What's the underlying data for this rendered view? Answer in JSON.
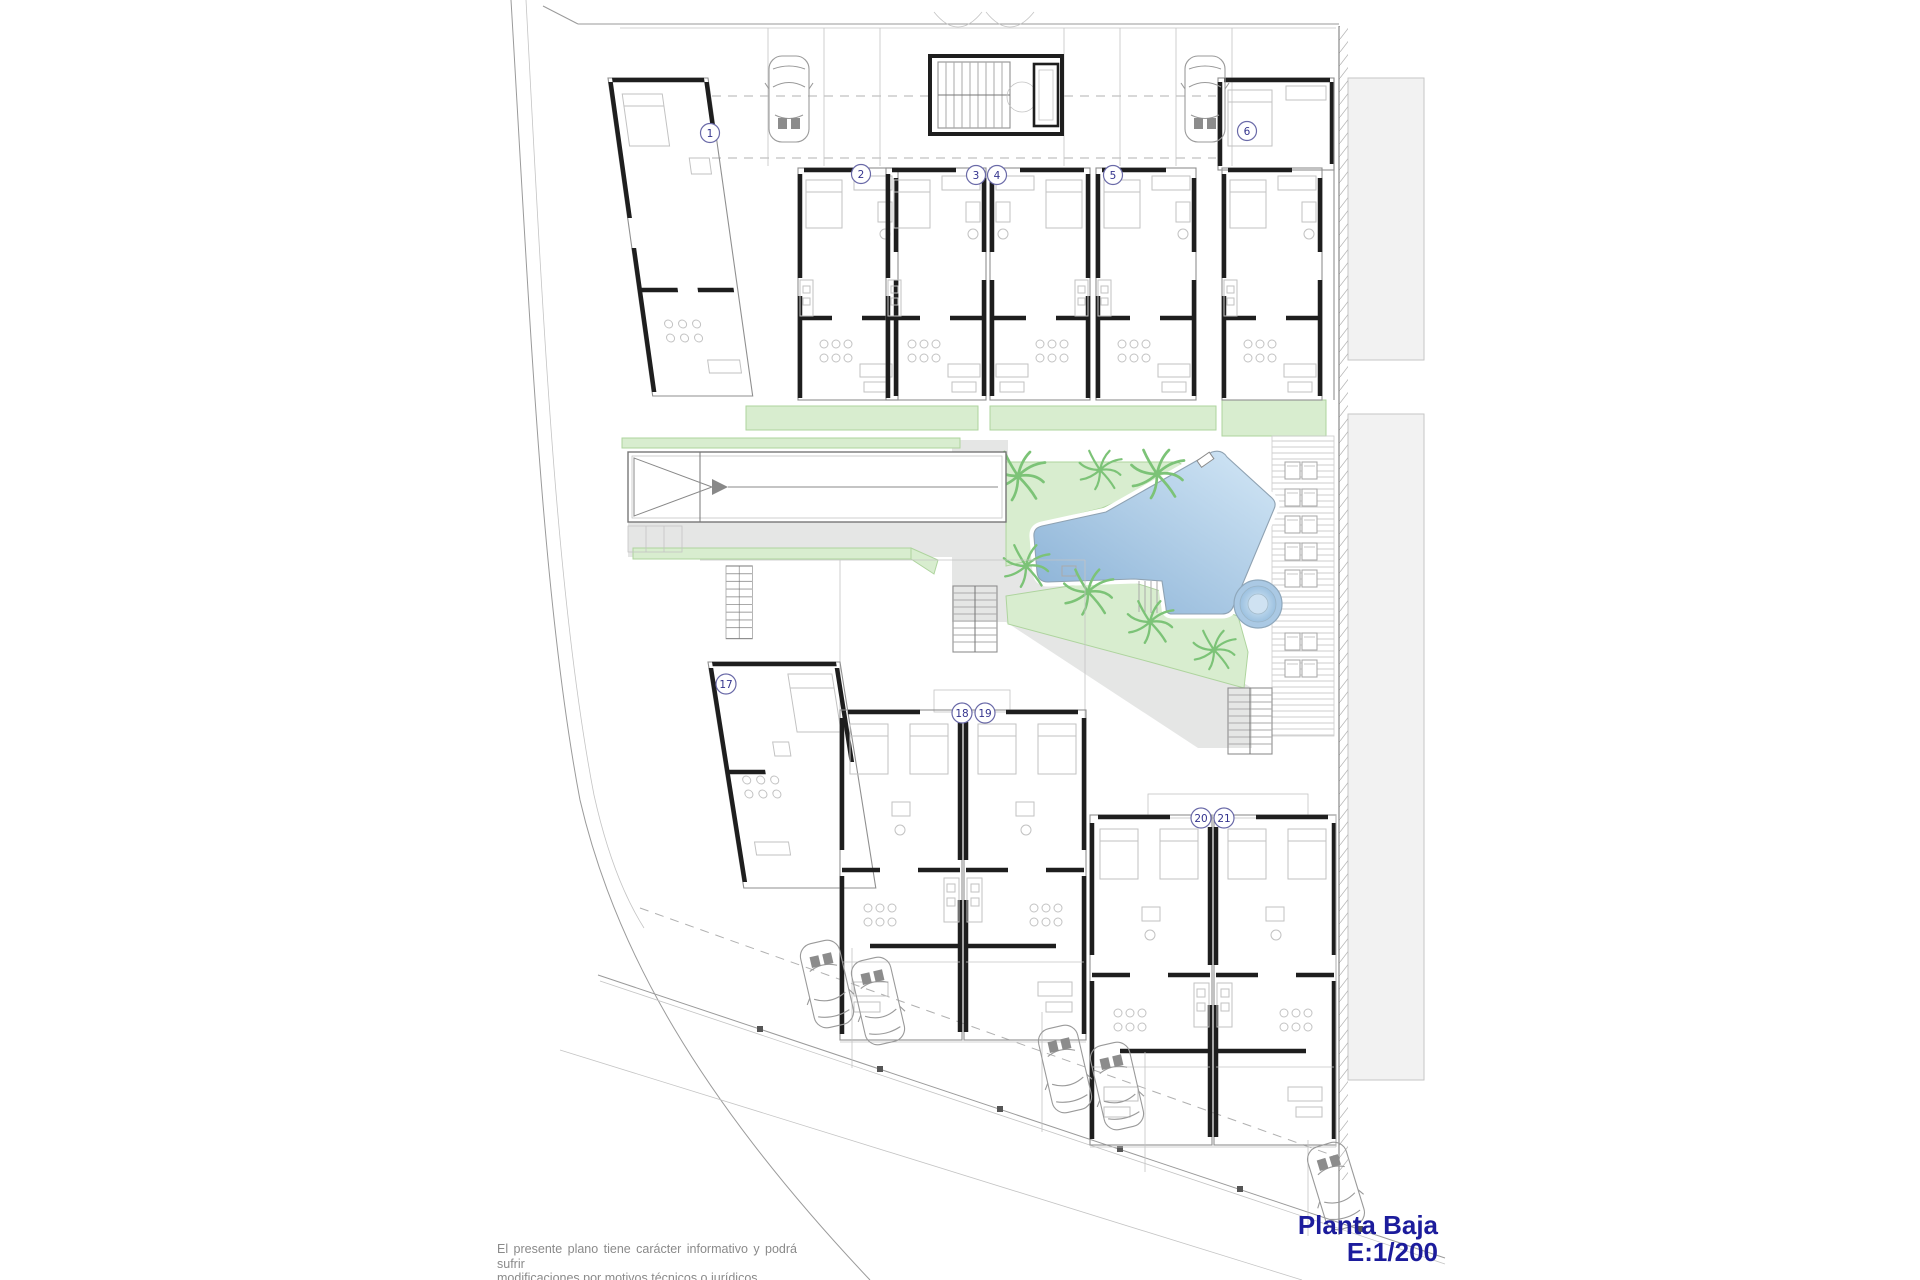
{
  "drawing": {
    "title_line1": "Planta Baja",
    "title_line2": "E:1/200",
    "disclaimer_line1": "El presente plano tiene carácter informativo y podrá sufrir",
    "disclaimer_line2": "modificaciones por motivos técnicos o jurídicos."
  },
  "unit_labels": [
    "1",
    "2",
    "3",
    "4",
    "5",
    "6",
    "17",
    "18",
    "19",
    "20",
    "21"
  ],
  "colors": {
    "title_blue": "#1c1c9c",
    "label_blue": "#34348e",
    "pool_light": "#d3e7f6",
    "pool_dark": "#88b0d5",
    "green": "#d8edcf",
    "green_edge": "#aed49e",
    "palm_green": "#7cc377",
    "path_gray": "#e5e6e5",
    "wall_black": "#1e1e1e",
    "furniture_gray": "#c2c2c2",
    "neighbor_gray": "#f2f2f2",
    "disclaimer_gray": "#8a8a8a"
  }
}
